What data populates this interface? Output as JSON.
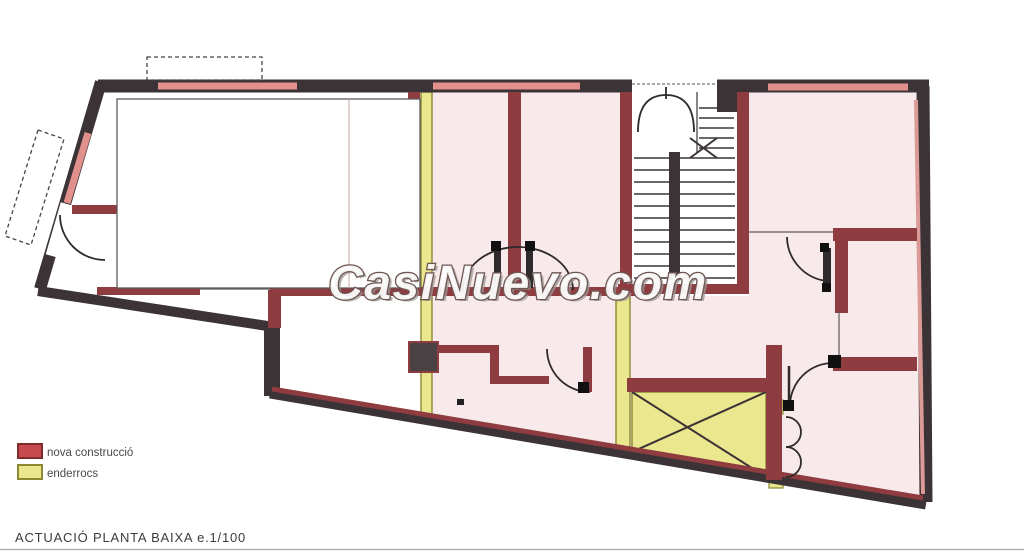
{
  "watermark": {
    "text": "CasiNuevo.com"
  },
  "legend": {
    "items": [
      {
        "label": "nova construcció",
        "color": "#c64a50",
        "border": "#7d2b2b"
      },
      {
        "label": "enderrocs",
        "color": "#ebe78f",
        "border": "#8a8a35"
      }
    ]
  },
  "caption": {
    "text": "ACTUACIÓ PLANTA BAIXA e.1/100"
  },
  "colors": {
    "new_construction_wall": "#8e3c40",
    "exterior_wall": "#3b3336",
    "demolition": "#ebe78f",
    "room_fill": "#f8eaea",
    "wall_band_pink": "#e2908c"
  }
}
